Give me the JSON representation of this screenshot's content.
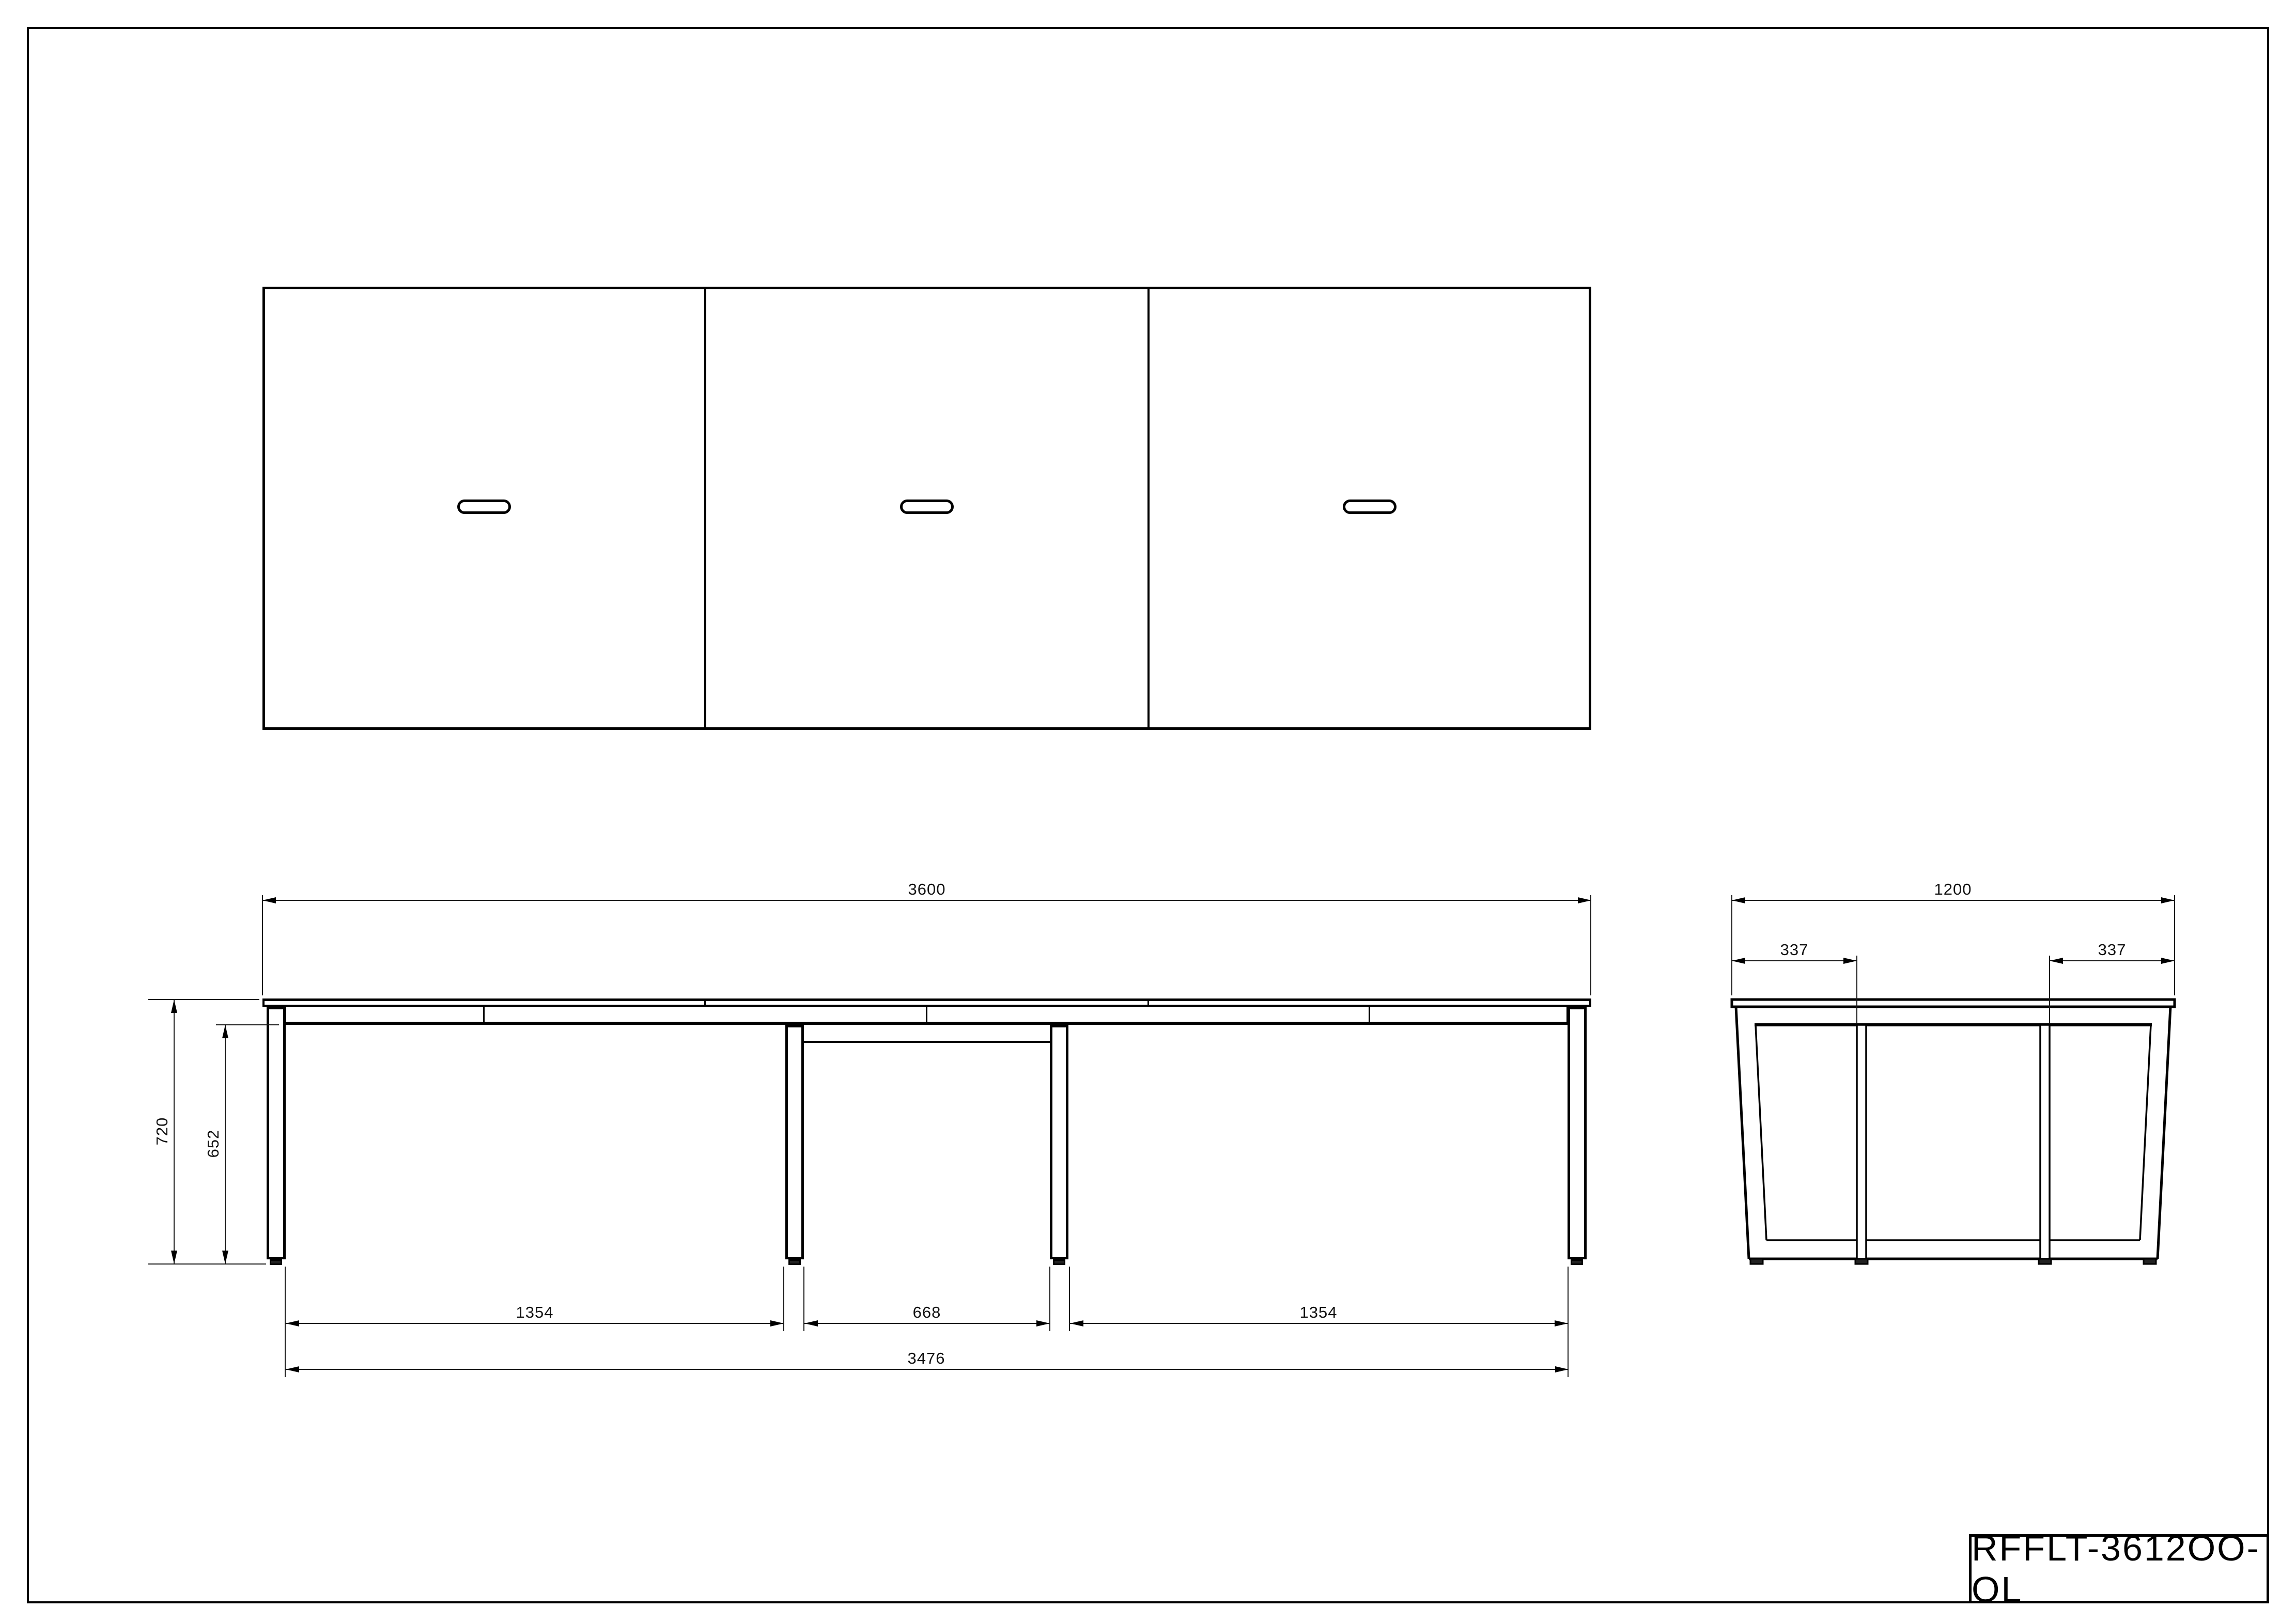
{
  "drawing": {
    "title_block": {
      "code": "RFFLT-3612OO-OL"
    },
    "front_view": {
      "dims": {
        "total_width": "3600",
        "total_height": "720",
        "underframe_height": "652",
        "left_leg_span": "1354",
        "center_opening": "668",
        "right_leg_span": "1354",
        "foot_span": "3476"
      }
    },
    "side_view": {
      "dims": {
        "depth": "1200",
        "front_post_offset": "337",
        "rear_post_offset": "337"
      }
    },
    "plan_view": {
      "panel_count": 3,
      "grommet_count": 3
    },
    "colors": {
      "line": "#000000",
      "background": "#ffffff"
    }
  }
}
